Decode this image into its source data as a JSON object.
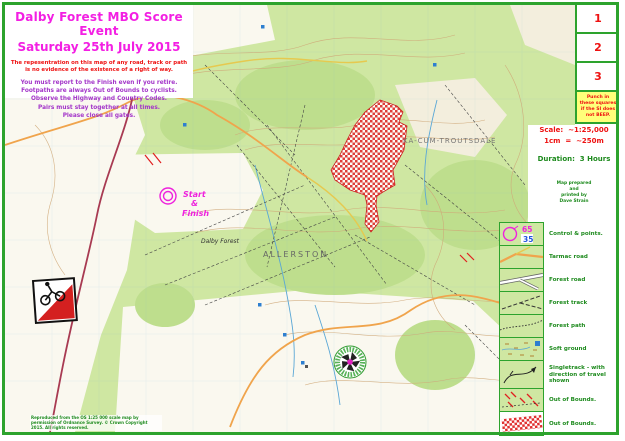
{
  "header": {
    "title_line1": "Dalby Forest MBO Score Event",
    "title_line2": "Saturday 25th July 2015",
    "disclaimer_line1": "The repesentration on this map of any road, track or path",
    "disclaimer_line2": "is no evidence of the existence of a right of way.",
    "instructions": [
      "You must report to the Finish even if you retire.",
      "Footpaths are always Out of Bounds to cyclists.",
      "Observe the Highway and Country Codes.",
      "Pairs must stay together at all times.",
      "Please close all gates."
    ]
  },
  "punch_panel": {
    "boxes": [
      "1",
      "2",
      "3"
    ],
    "note": "Punch in these squares if the SI does not BEEP."
  },
  "info_panel": {
    "scale_line1": "Scale:  ~1:25,000",
    "scale_line2": "1cm  =  ~250m",
    "duration": "Duration:  3 Hours",
    "credit_lines": [
      "Map prepared",
      "and",
      "printed by",
      "Dave Strain"
    ]
  },
  "legend": {
    "control_code": "65",
    "control_points": "35",
    "items": [
      "Control & points.",
      "Tarmac road",
      "Forest road",
      "Forest track",
      "Forest path",
      "Soft ground",
      "Singletrack - with direction of travel shown",
      "Out of Bounds.",
      "Out of Bounds."
    ]
  },
  "map": {
    "start_label": "Start",
    "amp_label": "&",
    "finish_label": "Finish",
    "label_forest": "Dalby Forest",
    "label_village": "ALLERSTON",
    "label_troutsdale": "KA-CUM-TROUTSDALE",
    "copyright": "Reproduced from the OS 1:25 000 scale map by permission of Ordnance Survey. © Crown Copyright 2015. All rights reserved."
  },
  "colors": {
    "frame_green": "#2da32d",
    "title_magenta": "#f31fe3",
    "warning_red": "#ee1111",
    "instruction_purple": "#a335c9",
    "legend_green": "#1d8a1d",
    "oob_red": "#e03030"
  }
}
